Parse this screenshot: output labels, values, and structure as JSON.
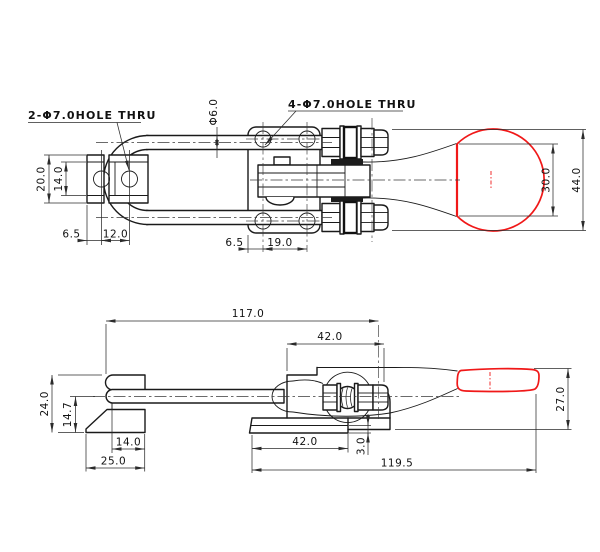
{
  "drawing": {
    "top_view": {
      "note_left_holes": "2-Φ7.0HOLE THRU",
      "note_right_holes": "4-Φ7.0HOLE THRU",
      "dim_bar_diameter": "Φ6.0",
      "dim_keeper_outer_height": "20.0",
      "dim_keeper_inner_height": "14.0",
      "dim_keeper_edge_to_hole": "6.5",
      "dim_keeper_hole_spacing": "12.0",
      "dim_base_edge_to_hole": "6.5",
      "dim_base_hole_spacing": "19.0",
      "dim_knob_flat": "30.0",
      "dim_knob_diameter": "44.0"
    },
    "side_view": {
      "dim_overall_length": "117.0",
      "dim_base_top_length": "42.0",
      "dim_keeper_height": "24.0",
      "dim_hook_centerline_height": "14.7",
      "dim_keeper_hole_offset": "14.0",
      "dim_keeper_base_length": "25.0",
      "dim_base_flange_length": "42.0",
      "dim_flange_thickness": "3.0",
      "dim_extended_length": "119.5",
      "dim_handle_height": "27.0"
    },
    "colors": {
      "outline": "#1a1a1a",
      "dimension": "#2b2b2b",
      "accent": "#f01818"
    }
  }
}
